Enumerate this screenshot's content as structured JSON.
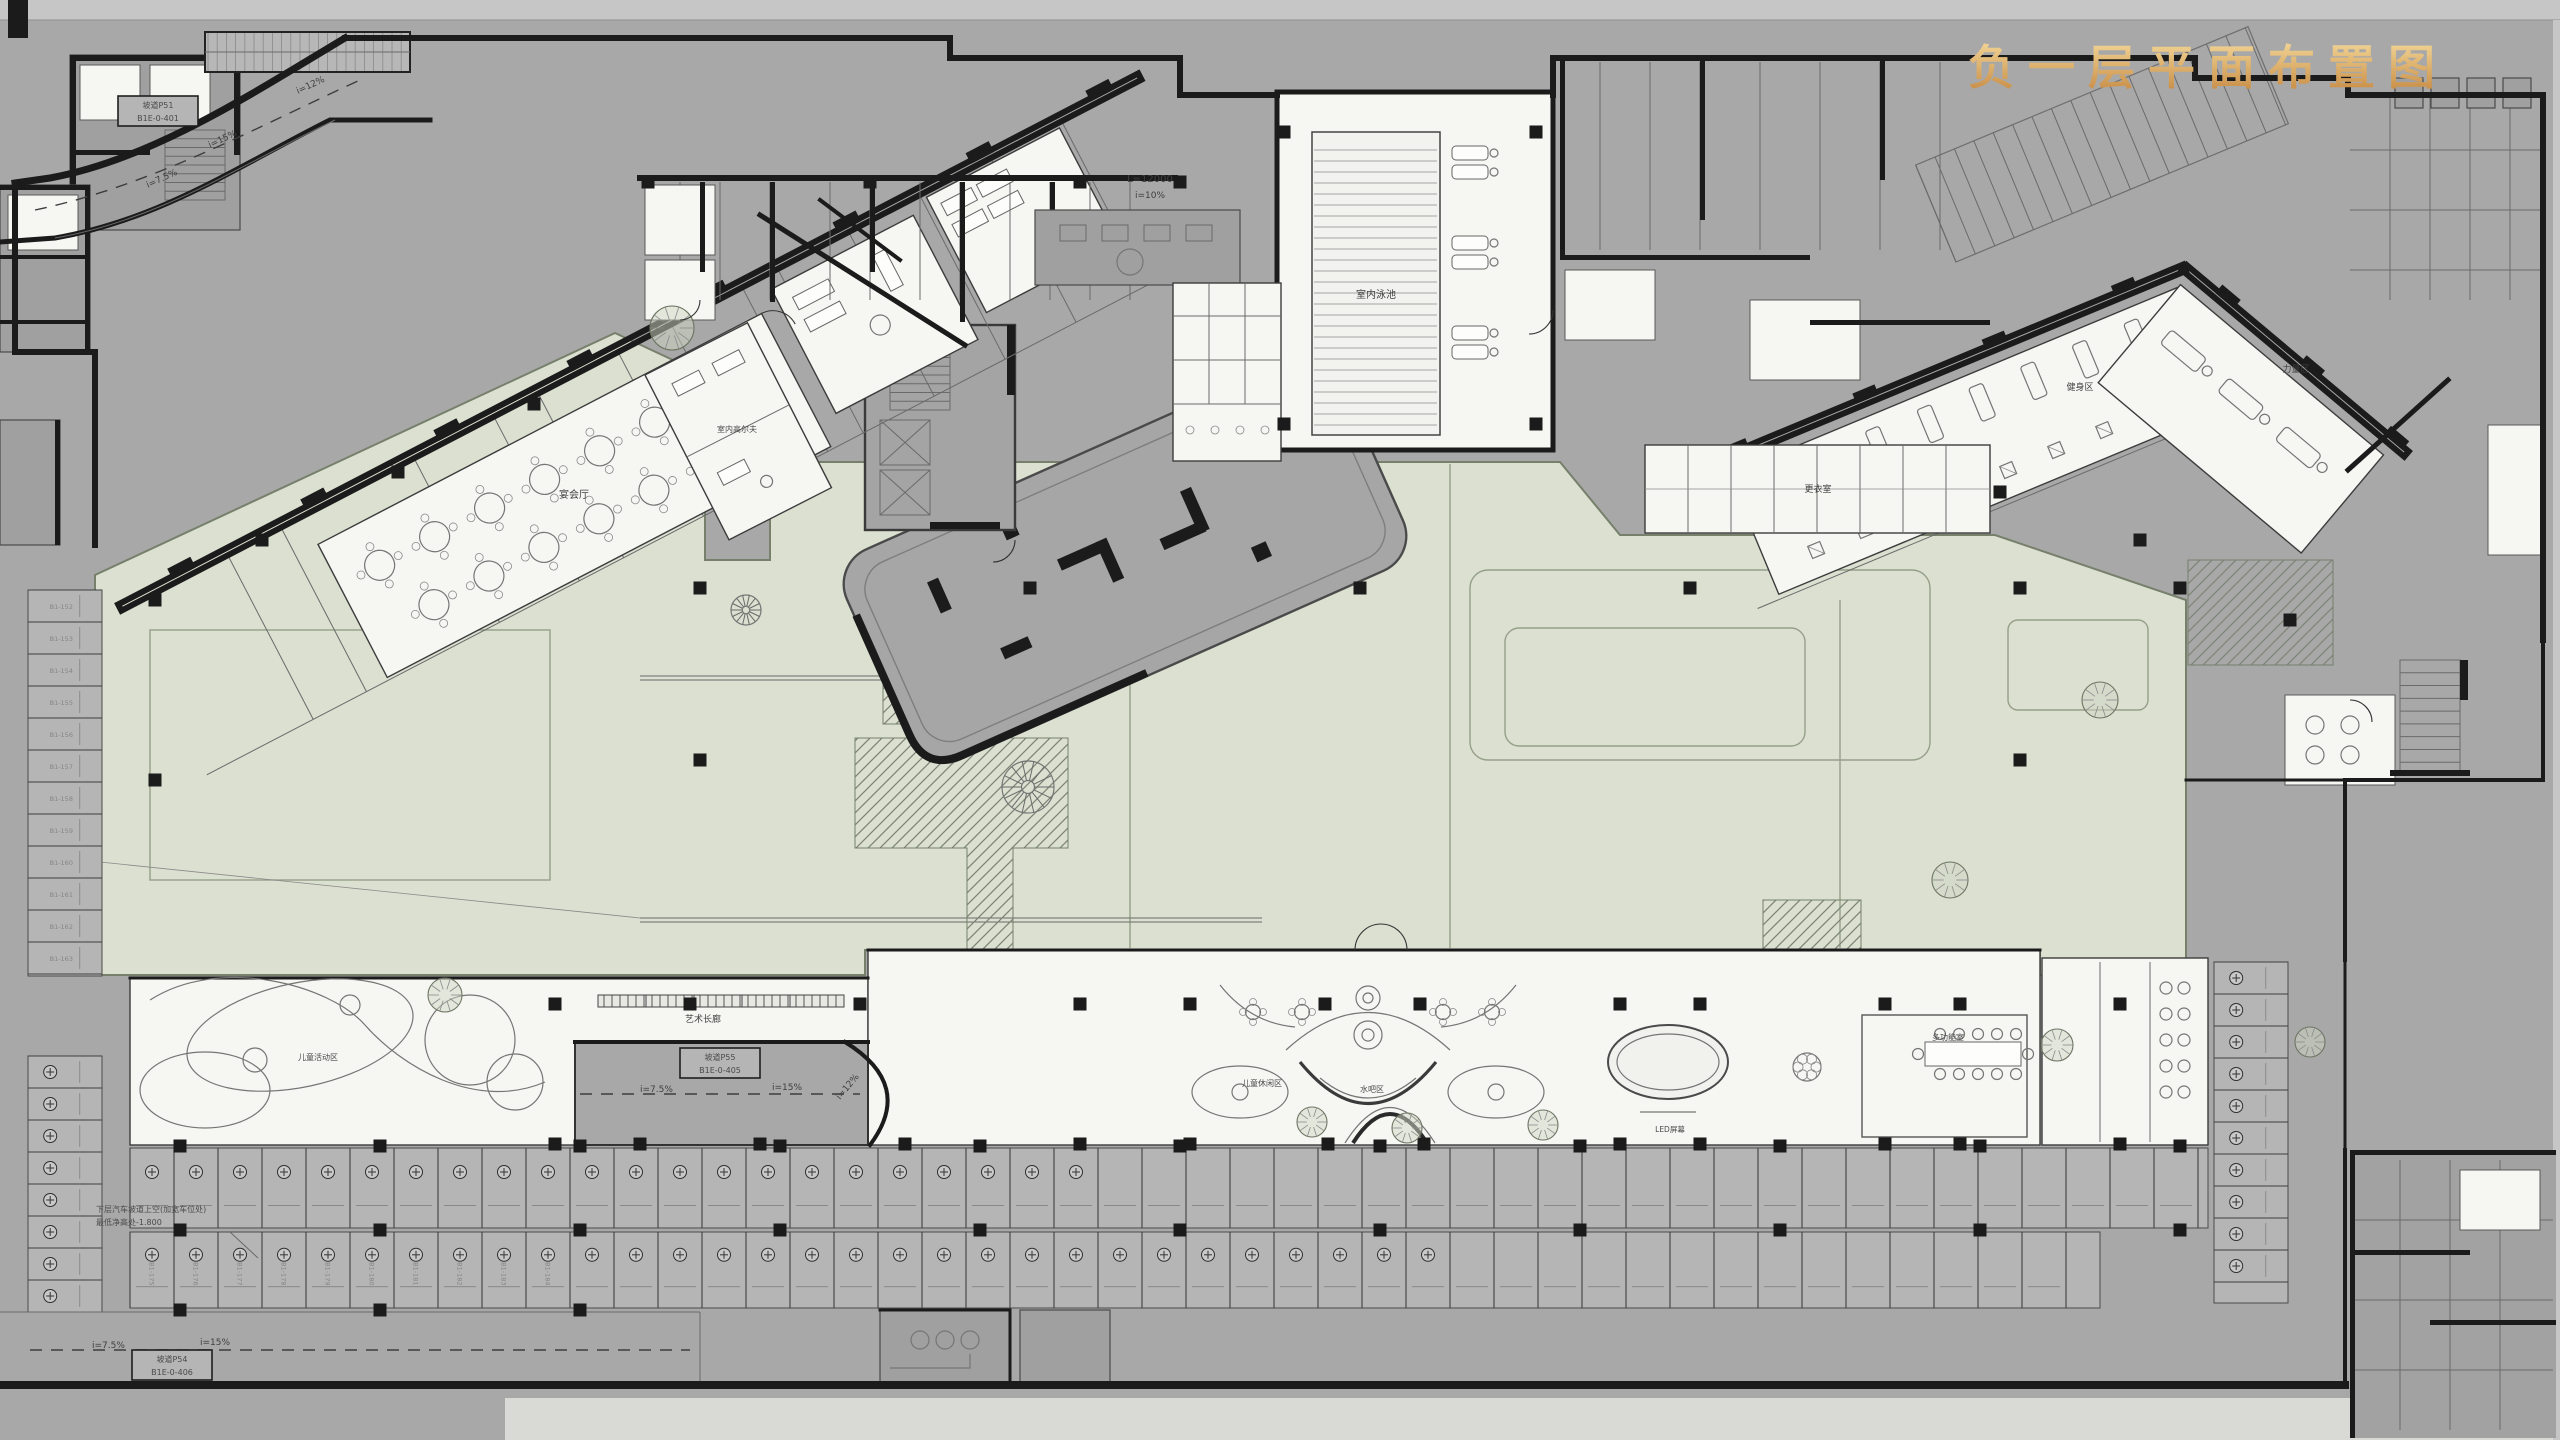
{
  "title": "负一层平面布置图",
  "labels": {
    "pool": "室内泳池",
    "changing": "更衣室",
    "gym": "健身区",
    "strength": "力量区",
    "banquet": "宴会厅",
    "golf": "室内高尔夫",
    "gallery": "艺术长廊",
    "water_bar": "水吧区",
    "kids_lounge": "儿童休闲区",
    "kids_zone": "儿童活动区",
    "multi_room": "多功能室",
    "led": "LED屏幕",
    "slope_12": "i=12%",
    "slope_15": "i=15%",
    "slope_75": "i=7.5%",
    "slope_10": "i=10%",
    "len_12000": "L=12000",
    "ramp_p51": "坡道P51",
    "ramp_p51_no": "B1E-0-401",
    "ramp_p54": "坡道P54",
    "ramp_p54_no": "B1E-0-406",
    "ramp_p55": "坡道P55",
    "ramp_p55_no": "B1E-0-405",
    "clearance_note_1": "下层汽车坡道上空(加宽车位处)",
    "clearance_note_2": "最低净高处-1.800"
  },
  "parking": {
    "stall_prefix": "B1-",
    "left_column_numbers": [
      "B1-152",
      "B1-153",
      "B1-154",
      "B1-155",
      "B1-156",
      "B1-157",
      "B1-158",
      "B1-159",
      "B1-160",
      "B1-161",
      "B1-162",
      "B1-163"
    ],
    "bottom_row_numbers": [
      "B1-175",
      "B1-176",
      "B1-177",
      "B1-178",
      "B1-179",
      "B1-180",
      "B1-181",
      "B1-182",
      "B1-183",
      "B1-184"
    ]
  },
  "colors": {
    "background": "#a8a8a8",
    "plaza_green": "#dbe0d1",
    "room_white": "#f6f6f3",
    "wall_black": "#1b1b1b",
    "stall_gray": "#b5b5b5",
    "title_gold_light": "#f2d596",
    "title_gold_dark": "#c5873f"
  }
}
